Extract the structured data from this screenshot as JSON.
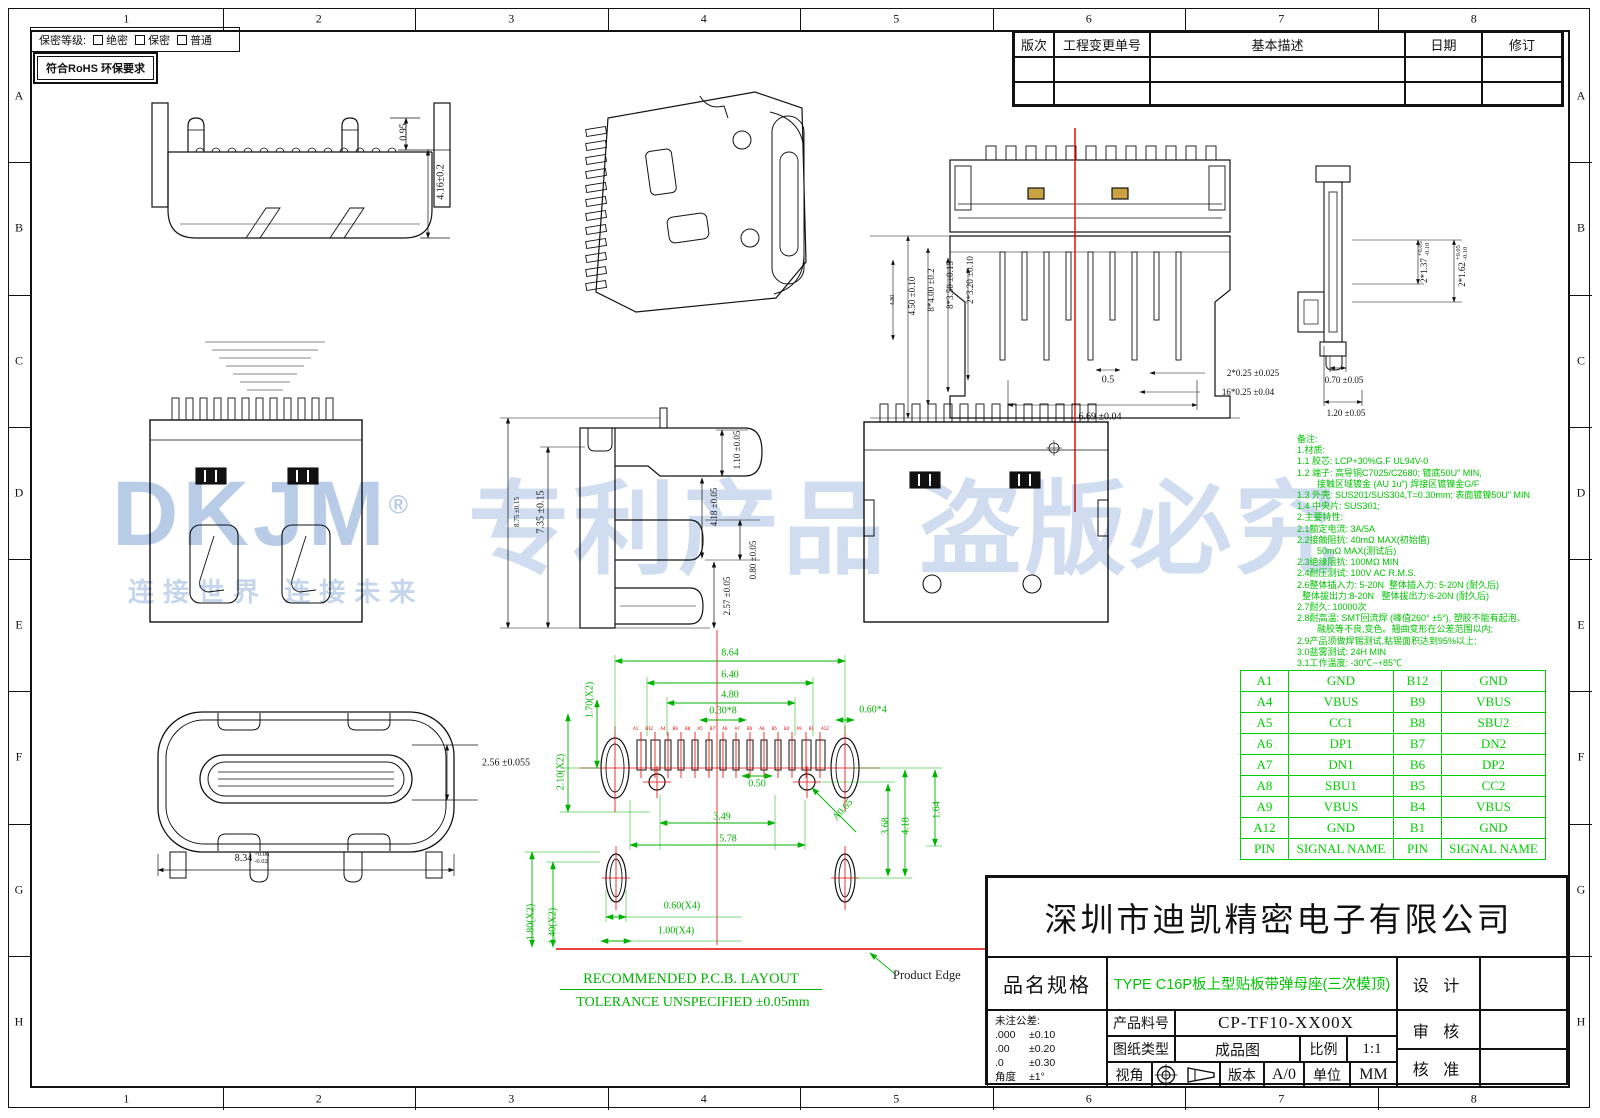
{
  "frame": {
    "cols": [
      "1",
      "2",
      "3",
      "4",
      "5",
      "6",
      "7",
      "8"
    ],
    "rows": [
      "A",
      "B",
      "C",
      "D",
      "E",
      "F",
      "G",
      "H"
    ]
  },
  "topbar": {
    "security_label": "保密等级:",
    "security_options": [
      "绝密",
      "保密",
      "普通"
    ],
    "rohs_text": "符合RoHS 环保要求"
  },
  "revision_table": {
    "headers": [
      "版次",
      "工程变更单号",
      "基本描述",
      "日期",
      "修订"
    ],
    "empty_rows": 2
  },
  "watermark": {
    "brand": "DKJM",
    "reg": "®",
    "slogan": "连接世界 连接未来",
    "statement": "专利产品 盗版必究"
  },
  "annotations": {
    "dims": [
      {
        "t": "0.95",
        "x": 404,
        "y": 132,
        "r": -90
      },
      {
        "t": "4.16±0.2",
        "x": 441,
        "y": 182,
        "r": -90
      },
      {
        "t": "2.56 ±0.055",
        "x": 506,
        "y": 763
      },
      {
        "t": "8.34",
        "tp": "+0.06",
        "tm": "-0.02",
        "x": 252,
        "y": 858
      },
      {
        "t": "8.75 ±0.15",
        "x": 517,
        "y": 512,
        "r": -90,
        "s": 7
      },
      {
        "t": "7.35 ±0.15",
        "x": 541,
        "y": 512,
        "r": -90
      },
      {
        "t": "1.10 ±0.05",
        "x": 737,
        "y": 450,
        "r": -90,
        "s": 9
      },
      {
        "t": "4.18 ±0.05",
        "x": 714,
        "y": 507,
        "r": -90,
        "s": 9
      },
      {
        "t": "0.80 ±0.05",
        "x": 753,
        "y": 560,
        "r": -90,
        "s": 9
      },
      {
        "t": "2.57 ±0.05",
        "x": 727,
        "y": 596,
        "r": -90,
        "s": 9
      },
      {
        "t": "4.80",
        "x": 893,
        "y": 300,
        "r": -90,
        "s": 6
      },
      {
        "t": "4.50 ±0.10",
        "x": 912,
        "y": 296,
        "r": -90,
        "s": 9
      },
      {
        "t": "8*4.00 ±0.2",
        "x": 931,
        "y": 290,
        "r": -90,
        "s": 9
      },
      {
        "t": "8*3.50 ±0.15",
        "x": 950,
        "y": 285,
        "r": -90,
        "s": 9
      },
      {
        "t": "2*3.20 ±0.10",
        "x": 970,
        "y": 280,
        "r": -90,
        "s": 9
      },
      {
        "t": "0.5",
        "x": 1108,
        "y": 380
      },
      {
        "t": "6.69 ±0.04",
        "x": 1100,
        "y": 417
      },
      {
        "t": "2*0.25 ±0.025",
        "x": 1253,
        "y": 373,
        "s": 9
      },
      {
        "t": "16*0.25 ±0.04",
        "x": 1248,
        "y": 392,
        "s": 9
      },
      {
        "t": "2*1.37",
        "tp": "+0.05",
        "tm": "-0.10",
        "x": 1424,
        "y": 262,
        "r": -90,
        "s": 9
      },
      {
        "t": "2*1.62",
        "tp": "+0.05",
        "tm": "-0.10",
        "x": 1462,
        "y": 266,
        "r": -90,
        "s": 9
      },
      {
        "t": "0.70 ±0.05",
        "x": 1344,
        "y": 380,
        "s": 9
      },
      {
        "t": "1.20 ±0.05",
        "x": 1346,
        "y": 413,
        "s": 9
      },
      {
        "t": "8.64",
        "x": 730,
        "y": 653,
        "c": "g"
      },
      {
        "t": "6.40",
        "x": 730,
        "y": 675,
        "c": "g"
      },
      {
        "t": "4.80",
        "x": 730,
        "y": 695,
        "c": "g"
      },
      {
        "t": "0.30*8",
        "x": 723,
        "y": 711,
        "c": "g"
      },
      {
        "t": "0.60*4",
        "x": 873,
        "y": 710,
        "c": "g"
      },
      {
        "t": "1.70(X2)",
        "x": 590,
        "y": 700,
        "r": -90,
        "c": "g"
      },
      {
        "t": "2.10(X2)",
        "x": 561,
        "y": 772,
        "r": -90,
        "c": "g"
      },
      {
        "t": "0.50",
        "x": 757,
        "y": 784,
        "c": "g"
      },
      {
        "t": "3.49",
        "x": 722,
        "y": 817,
        "c": "g"
      },
      {
        "t": "5.78",
        "x": 728,
        "y": 839,
        "c": "g"
      },
      {
        "t": "A0.65",
        "x": 843,
        "y": 810,
        "r": -48,
        "c": "g"
      },
      {
        "t": "1.64",
        "x": 937,
        "y": 810,
        "r": -90,
        "c": "g"
      },
      {
        "t": "3.68",
        "x": 886,
        "y": 826,
        "r": -90,
        "c": "g"
      },
      {
        "t": "4.18",
        "x": 906,
        "y": 826,
        "r": -90,
        "c": "g"
      },
      {
        "t": "0.60(X4)",
        "x": 682,
        "y": 906,
        "c": "g"
      },
      {
        "t": "1.00(X4)",
        "x": 676,
        "y": 931,
        "c": "g"
      },
      {
        "t": "1.80(X2)",
        "x": 531,
        "y": 922,
        "r": -90,
        "c": "g"
      },
      {
        "t": "1.40(X2)",
        "x": 553,
        "y": 926,
        "r": -90,
        "c": "g"
      }
    ],
    "pad_labels": [
      "A1",
      "B12",
      "A4",
      "B9",
      "B8",
      "A5",
      "B7",
      "A6",
      "A7",
      "B6",
      "A8",
      "B5",
      "B4",
      "A9",
      "B1",
      "A12"
    ]
  },
  "pcb": {
    "layout_title": "RECOMMENDED P.C.B. LAYOUT",
    "tolerance_note": "TOLERANCE UNSPECIFIED ±0.05mm",
    "product_edge_label": "Product Edge"
  },
  "notes": {
    "lines": [
      "备注:",
      "1.材质:",
      "1.1 胶芯: LCP+30%G.F UL94V-0",
      "1.2 端子: 高导铜C7025/C2680; 镀底50U\" MIN,",
      "        接触区域镀金 (AU 1u\") 焊接区镀镍金G/F",
      "1.3 外壳: SUS201/SUS304,T=0.30mm; 表面镀镍50U\" MIN",
      "1.4 中央片: SUS301;",
      "2.主要特性:",
      "2.1额定电流: 3A/5A",
      "2.2接触阻抗: 40mΩ MAX(初始值)",
      "        50mΩ MAX(测试后)",
      "2.3绝缘阻抗: 100MΩ MIN",
      "2.4耐压测试: 100V AC R.M.S.",
      "2.6整体插入力: 5-20N  整体插入力: 5-20N (耐久后)",
      "  整体拔出力:8-20N   整体拔出力:6-20N (耐久后)",
      "2.7耐久: 10000次",
      "2.8耐高温: SMT回流焊 (峰值260° ±5°), 塑胶不能有起泡、",
      "        融胶等不良,变色。翘曲变形在公差范围以内;",
      "2.9产品须做焊锡测试,粘锡面积达到95%以上;",
      "3.0盐雾测试: 24H MIN",
      "3.1工作温度: -30℃~+85℃"
    ]
  },
  "pin_table": {
    "rows": [
      [
        "A1",
        "GND",
        "B12",
        "GND"
      ],
      [
        "A4",
        "VBUS",
        "B9",
        "VBUS"
      ],
      [
        "A5",
        "CC1",
        "B8",
        "SBU2"
      ],
      [
        "A6",
        "DP1",
        "B7",
        "DN2"
      ],
      [
        "A7",
        "DN1",
        "B6",
        "DP2"
      ],
      [
        "A8",
        "SBU1",
        "B5",
        "CC2"
      ],
      [
        "A9",
        "VBUS",
        "B4",
        "VBUS"
      ],
      [
        "A12",
        "GND",
        "B1",
        "GND"
      ],
      [
        "PIN",
        "SIGNAL NAME",
        "PIN",
        "SIGNAL NAME"
      ]
    ]
  },
  "title_block": {
    "company": "深圳市迪凯精密电子有限公司",
    "part_spec_label": "品名规格",
    "part_spec": "TYPE C16P板上型贴板带弹母座(三次模顶)",
    "part_no_label": "产品料号",
    "part_no": "CP-TF10-XX00X",
    "doc_type_label": "图纸类型",
    "doc_type": "成品图",
    "scale_label": "比例",
    "scale": "1:1",
    "view_label": "视角",
    "version_label": "版本",
    "version": "A/0",
    "unit_label": "单位",
    "unit": "MM",
    "design_label": "设 计",
    "review_label": "审 核",
    "approve_label": "核 准",
    "tolerance_title": "未注公差:",
    "tolerances": [
      [
        ".000",
        "±0.10"
      ],
      [
        ".00",
        "±0.20"
      ],
      [
        ".0",
        "±0.30"
      ],
      [
        "角度",
        "±1°"
      ]
    ]
  },
  "colors": {
    "annotation_green": "#00c400",
    "table_green": "#00cf00",
    "centerline_red": "#e60000",
    "watermark_blue": "#8eacda",
    "line_black": "#111111",
    "pad_gold": "#c9a242"
  }
}
